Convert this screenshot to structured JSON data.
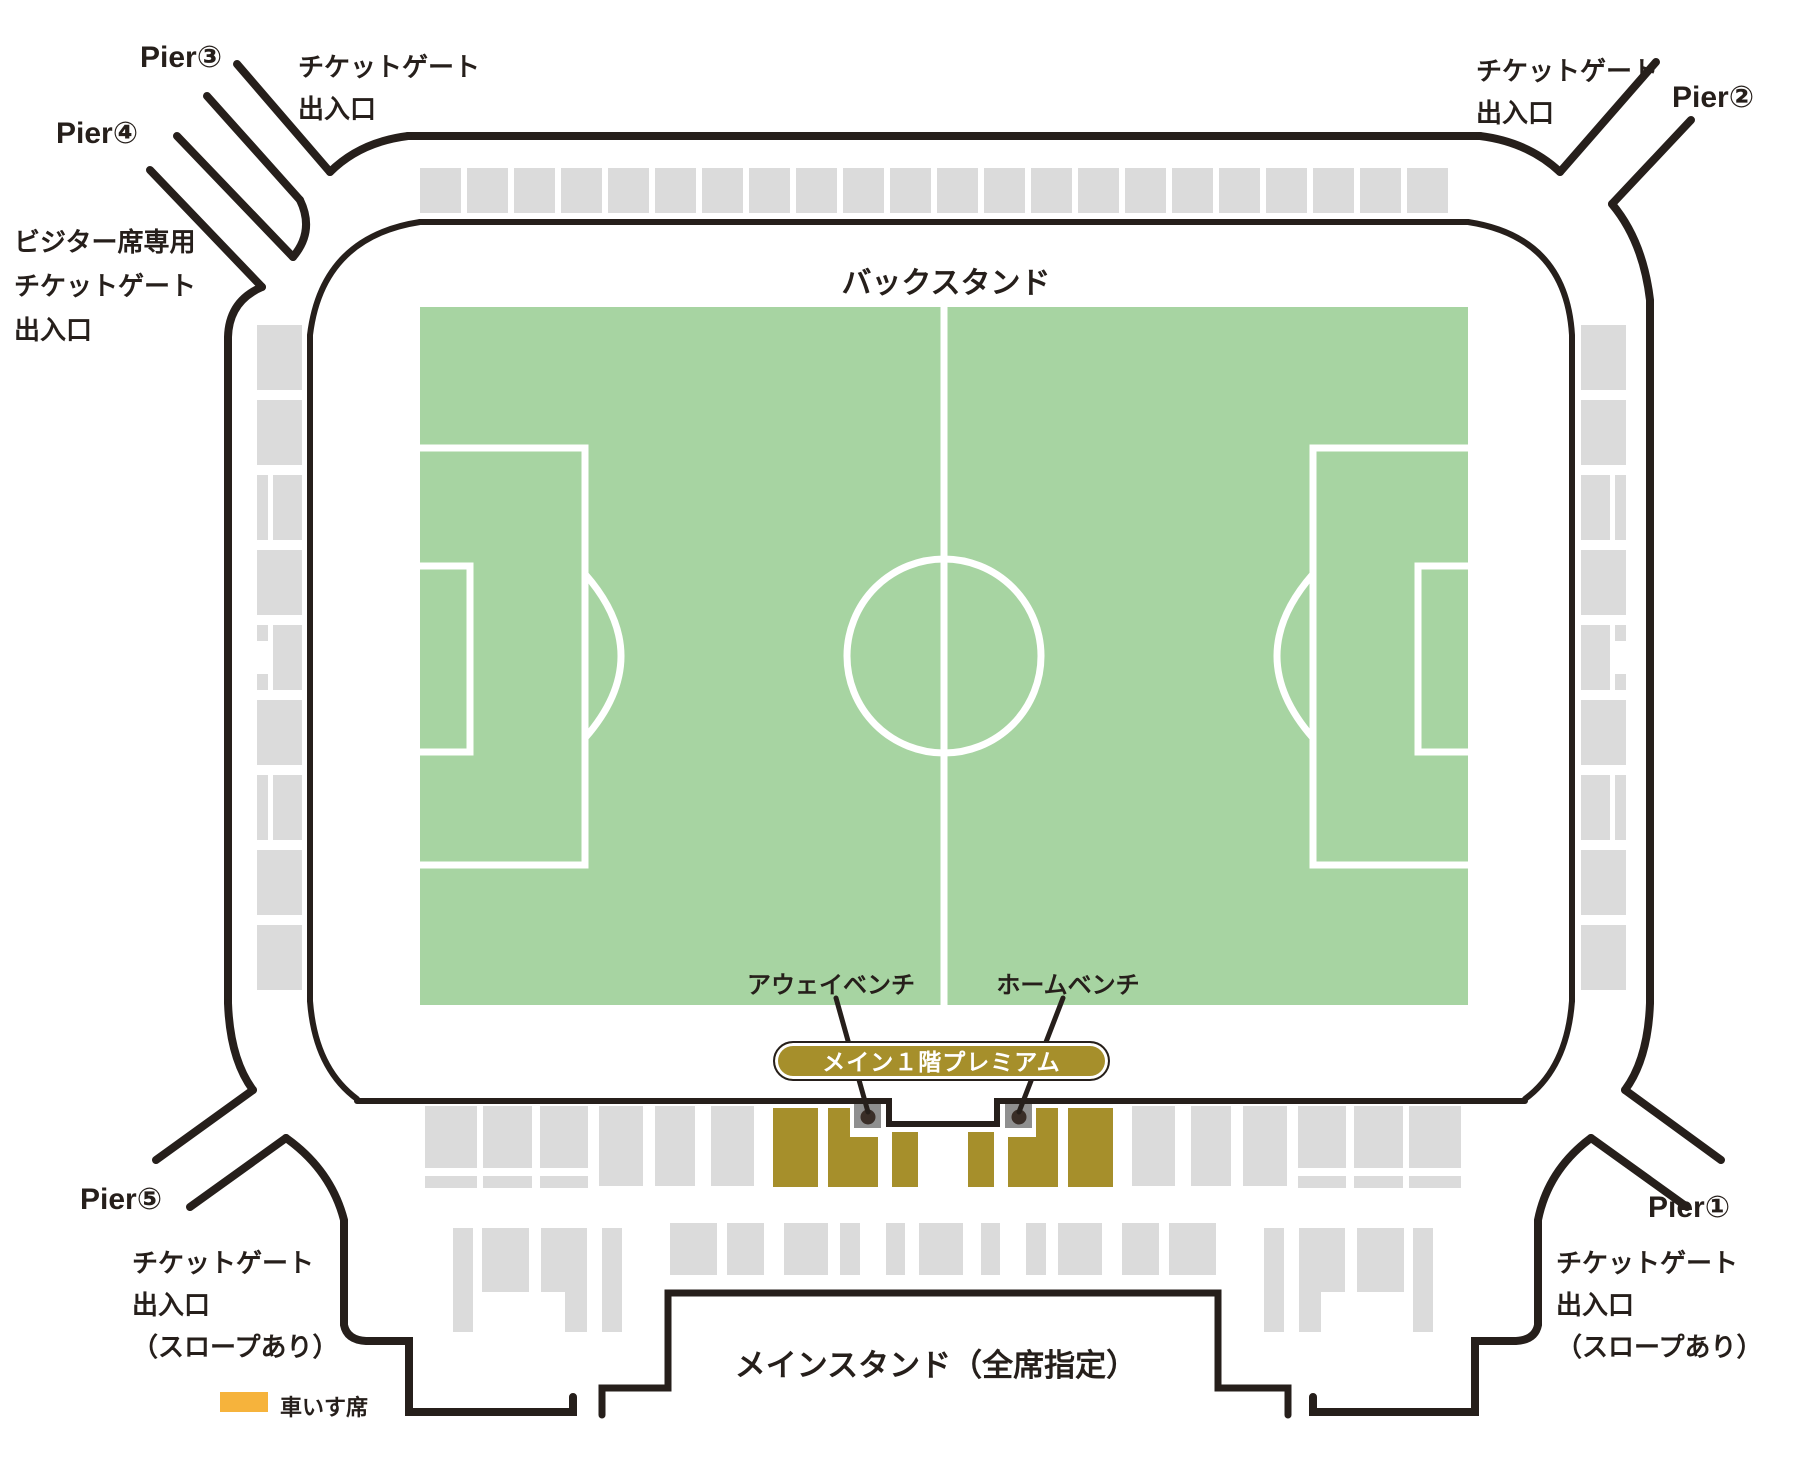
{
  "colors": {
    "ink": "#261f1b",
    "pitch_green": "#a7d4a2",
    "seat_gray": "#dbdbdb",
    "premium_gold": "#a68f2b",
    "wheelchair_orange": "#f6b33c",
    "bench_gray": "#8f8f8f",
    "bench_dot": "#3a2e28",
    "line_white": "#ffffff"
  },
  "labels": {
    "pier1": "Pier①",
    "pier2": "Pier②",
    "pier3": "Pier③",
    "pier4": "Pier④",
    "pier5": "Pier⑤",
    "gate_top_left": "チケットゲート\n出入口",
    "gate_top_right": "チケットゲート\n出入口",
    "visitor_gate": "ビジター席専用\nチケットゲート\n出入口",
    "gate_bottom_left": "チケットゲート\n出入口\n（スロープあり）",
    "gate_bottom_right": "チケットゲート\n出入口\n（スロープあり）",
    "back_stand": "バックスタンド",
    "main_stand": "メインスタンド（全席指定）",
    "away_bench": "アウェイベンチ",
    "home_bench": "ホームベンチ",
    "premium_pill": "メイン１階プレミアム",
    "wheelchair_legend": "車いす席"
  },
  "geometry": {
    "pitch": {
      "x": 420,
      "y": 307,
      "w": 1048,
      "h": 698
    },
    "center_circle": {
      "cx": 944,
      "cy": 656,
      "r": 97
    },
    "pitch_markings": [
      "M944 307V1005",
      "M420 448H585V865H420",
      "M420 566H470V752H420",
      "M585 574Q657 656 585 738",
      "M1468 448H1313V865H1468",
      "M1468 566H1418V752H1468",
      "M1313 574Q1241 656 1313 738"
    ],
    "outer_walls": [
      "M408 136H1480",
      "M408 136Q360 142 330 172",
      "M237 64L330 172",
      "M207 96L300 200",
      "M300 200Q315 231 293 257",
      "M293 257L177 136",
      "M150 170L262 287",
      "M262 287Q229 301 228 337V1003",
      "M1480 136Q1528 142 1560 172",
      "M1560 172L1656 62",
      "M1691 120L1612 204",
      "M1612 204Q1643 241 1650 300V1003",
      "M228 1003Q230 1059 253 1090",
      "M253 1090L156 1160",
      "M190 1207L286 1138",
      "M286 1138Q331 1170 344 1220V1325Q347 1340 366 1341H409V1412H573V1397",
      "M1650 1003Q1648 1059 1625 1090",
      "M1625 1090L1721 1160",
      "M1687 1207L1591 1138",
      "M1591 1138Q1548 1170 1538 1220V1325Q1535 1340 1516 1341H1475V1412H1313V1397"
    ],
    "inner_walls": [
      "M420 222H1468",
      "M420 222Q322 237 310 335V1001",
      "M1468 222Q1566 237 1572 335V1001",
      "M310 1001Q315 1068 357 1099",
      "M1572 1001Q1567 1068 1525 1099",
      "M357 1101H889V1124H997V1101H1525"
    ],
    "stand_box": "M602 1415V1388H668V1293H1218V1388H1288V1415",
    "bench_lines": [
      "M836 998L868 1112",
      "M1063 998L1019 1112"
    ],
    "benches": [
      {
        "x": 854,
        "y": 1104,
        "w": 27,
        "h": 24,
        "dot": [
          868,
          1117
        ]
      },
      {
        "x": 1005,
        "y": 1104,
        "w": 27,
        "h": 24,
        "dot": [
          1019,
          1117
        ]
      }
    ],
    "top_band": {
      "x0": 420,
      "count": 22,
      "pitch": 47,
      "w": 41,
      "y": 168,
      "h": 45
    },
    "left_column": {
      "x": 257,
      "mainx": 273,
      "narroww": 11,
      "mainw": 29,
      "w": 45,
      "y0": 325,
      "step": 75,
      "h": 65,
      "side": "left",
      "variants": [
        "full",
        "full",
        "split",
        "full",
        "notch",
        "full",
        "split",
        "full",
        "full"
      ]
    },
    "right_column": {
      "x": 1581,
      "mainx": 1581,
      "narrowx": 1615,
      "narroww": 11,
      "mainw": 29,
      "w": 45,
      "y0": 325,
      "step": 75,
      "h": 65,
      "side": "right",
      "variants": [
        "full",
        "full",
        "split",
        "full",
        "notch",
        "full",
        "split",
        "full",
        "full"
      ]
    },
    "row1_gray": [
      [
        425,
        1106,
        52,
        62
      ],
      [
        425,
        1176,
        52,
        12
      ],
      [
        483,
        1106,
        49,
        62
      ],
      [
        483,
        1176,
        49,
        12
      ],
      [
        540,
        1106,
        48,
        62
      ],
      [
        540,
        1176,
        48,
        12
      ],
      [
        599,
        1106,
        44,
        80
      ],
      [
        655,
        1106,
        40,
        80
      ],
      [
        711,
        1106,
        43,
        80
      ],
      [
        1132,
        1106,
        43,
        80
      ],
      [
        1191,
        1106,
        40,
        80
      ],
      [
        1243,
        1106,
        44,
        80
      ],
      [
        1298,
        1106,
        48,
        62
      ],
      [
        1298,
        1176,
        48,
        12
      ],
      [
        1354,
        1106,
        49,
        62
      ],
      [
        1354,
        1176,
        49,
        12
      ],
      [
        1409,
        1106,
        52,
        62
      ],
      [
        1409,
        1176,
        52,
        12
      ]
    ],
    "row1_gold": [
      [
        773,
        1108,
        45,
        79
      ],
      [
        828,
        1108,
        22,
        79
      ],
      [
        850,
        1137,
        28,
        50
      ],
      [
        892,
        1132,
        26,
        55
      ],
      [
        968,
        1132,
        26,
        55
      ],
      [
        1008,
        1137,
        28,
        50
      ],
      [
        1036,
        1108,
        22,
        79
      ],
      [
        1068,
        1108,
        45,
        79
      ]
    ],
    "row2_gray": [
      [
        453,
        1228,
        20,
        104
      ],
      [
        482,
        1228,
        47,
        64
      ],
      [
        541,
        1228,
        46,
        64
      ],
      [
        565,
        1292,
        22,
        40
      ],
      [
        602,
        1228,
        20,
        104
      ],
      [
        670,
        1223,
        47,
        52
      ],
      [
        727,
        1223,
        37,
        52
      ],
      [
        784,
        1223,
        44,
        52
      ],
      [
        840,
        1223,
        20,
        52
      ],
      [
        886,
        1223,
        19,
        52
      ],
      [
        919,
        1223,
        44,
        52
      ],
      [
        981,
        1223,
        19,
        52
      ],
      [
        1026,
        1223,
        20,
        52
      ],
      [
        1058,
        1223,
        44,
        52
      ],
      [
        1122,
        1223,
        37,
        52
      ],
      [
        1169,
        1223,
        47,
        52
      ],
      [
        1264,
        1228,
        20,
        104
      ],
      [
        1299,
        1228,
        46,
        64
      ],
      [
        1299,
        1292,
        22,
        40
      ],
      [
        1357,
        1228,
        47,
        64
      ],
      [
        1413,
        1228,
        20,
        104
      ]
    ]
  }
}
